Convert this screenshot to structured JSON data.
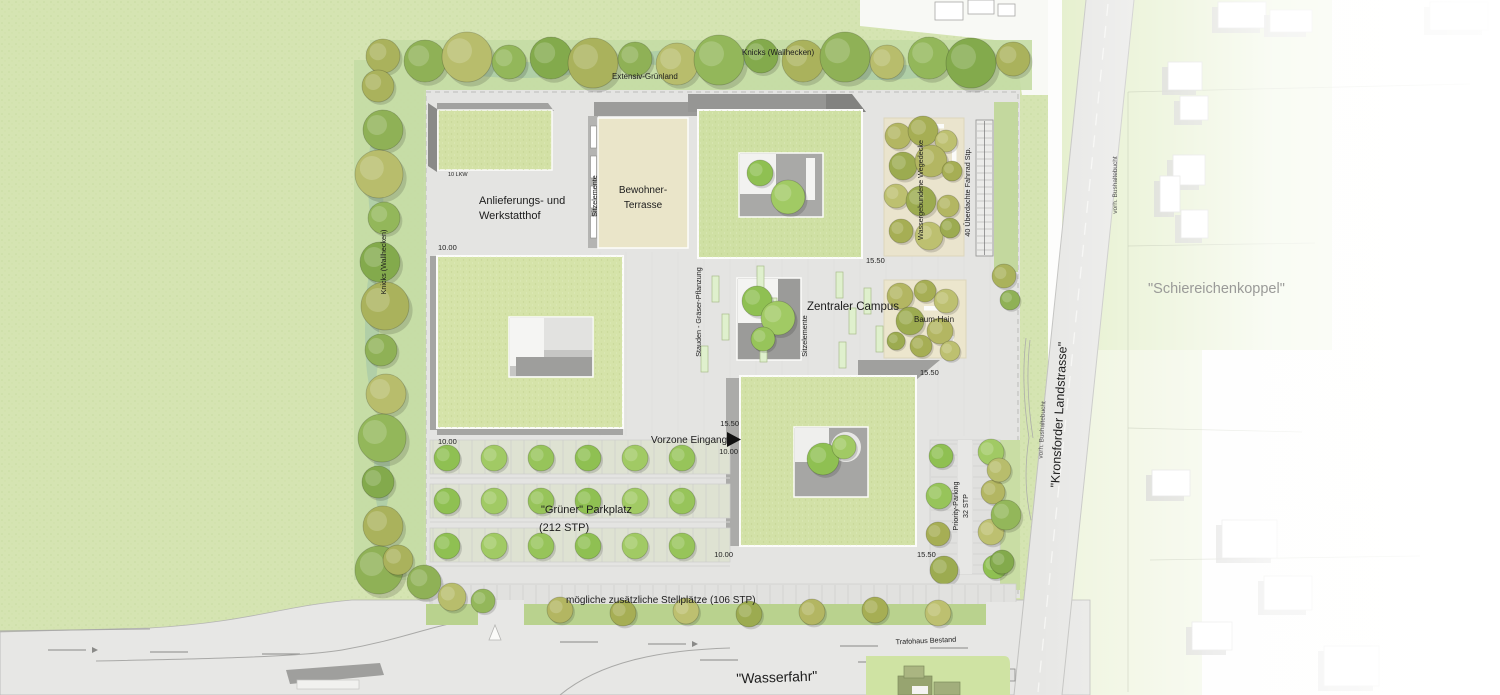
{
  "plan_title": "Lageplan Campus",
  "labels": {
    "extensiv_gruenland": "Extensiv-Grünland",
    "knicks_wallhecken_top": "Knicks (Wallhecken)",
    "knicks_wallhecken_left": "Knicks (Wallhecken)",
    "lkw_note": "10 LKW",
    "anlieferung_line1": "Anlieferungs- und",
    "anlieferung_line2": "Werkstatthof",
    "bewohner_line1": "Bewohner-",
    "bewohner_line2": "Terrasse",
    "sitzelemente_terrasse": "Sitzelemente",
    "sitzelemente_campus": "Sitzelemente",
    "stauden_graeser": "Stauden - Gräser-Pflanzung",
    "zentraler_campus": "Zentraler Campus",
    "baum_hain": "Baum-Hain",
    "wegedecke": "Wassergebundene Wegedecke",
    "fahrrad_stp": "40 Überdachte Fahrrad Stp.",
    "vorzone_eingang": "Vorzone Eingang",
    "parkplatz_line1": "\"Grüner\" Parkplatz",
    "parkplatz_line2": "(212 STP)",
    "priority_line1": "Priority-Parking",
    "priority_line2": "32 STP",
    "stellplaetze": "mögliche zusätzliche Stellplätze (106 STP)",
    "trafohaus": "Trafohaus Bestand",
    "wasserfahr": "\"Wasserfahr\"",
    "kronsforder": "\"Kronsforder Landstrasse\"",
    "bushaltebucht_road": "vorh. Bushaltebucht",
    "bushaltebucht_north": "vorh. Bushaltebucht",
    "schiereichenkoppel": "\"Schiereichenkoppel\""
  },
  "dimensions": {
    "left_bldg_top": "10.00",
    "left_bldg_bottom": "10.00",
    "ne_bldg": "15.50",
    "entrance_top": "15.50",
    "entrance_bottom": "10.00",
    "se_bldg_top": "15.50",
    "se_bldg_bottom": "15.50",
    "se_bldg_bottom_left": "10.00"
  },
  "palette": {
    "meadow": "#d5e4b2",
    "meadow_noise": "#b9d192",
    "hedge_teal": "#a4c7a8",
    "roof_green": "#d3e1a6",
    "paving": "#e4e4e2",
    "road": "#e7e7e5",
    "wall_gray": "#9b9b99",
    "shadow_gray": "#848482",
    "terrace_beige": "#eae5c9",
    "grove_beige": "#eae4cd",
    "verge_green": "#b9d28e",
    "ink": "#1c1c1c",
    "context_text": "#9a9a98",
    "tree_bright": [
      "#8fc052",
      "#a1ca64",
      "#97c45a"
    ],
    "tree_olive": [
      "#b3b662",
      "#a6ae54",
      "#bdc070",
      "#9cab50"
    ],
    "tree_mixed": [
      "#aab25c",
      "#8fb156",
      "#b8bd6c",
      "#93b75a",
      "#83aa4c"
    ]
  }
}
